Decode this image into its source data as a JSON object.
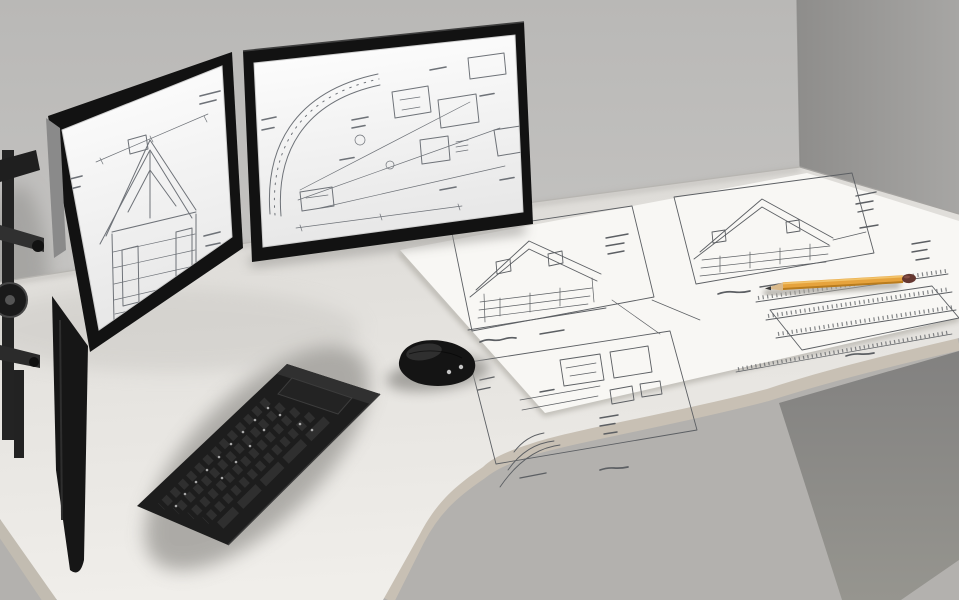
{
  "scene": {
    "type": "photo-illustration",
    "subject": "Corner office desk with a dual-monitor arm showing architectural blueprint drawings, a wireless keyboard, a mouse, a large blueprint sheet and a pencil",
    "objects": [
      {
        "name": "left-monitor",
        "shows": "house cross-section blueprint"
      },
      {
        "name": "right-monitor",
        "shows": "site plan blueprint with curved road"
      },
      {
        "name": "monitor-arm",
        "shows": "black articulated dual mount"
      },
      {
        "name": "blueprint-sheet",
        "shows": "house elevation and plan drawings"
      },
      {
        "name": "pencil",
        "shows": "orange pencil with dark eraser"
      },
      {
        "name": "keyboard",
        "shows": "black compact keyboard"
      },
      {
        "name": "mouse",
        "shows": "black wireless mouse"
      },
      {
        "name": "corner-desk",
        "shows": "light curved corner desktop"
      }
    ]
  },
  "palette": {
    "wall_left_top": "#b9b8b6",
    "wall_left_bottom": "#d2d1cf",
    "wall_right_near": "#8e8d8b",
    "wall_right_far": "#a7a6a4",
    "floor": "#b3b1ae",
    "under_desk_top": "#828180",
    "under_desk_bottom": "#96958f",
    "desk_back": "#dbd9d5",
    "desk_front": "#f0eeea",
    "desk_edge": "#c8c0b4",
    "desk_edge_left": "#c2bcb1",
    "paper": "#f8f7f4",
    "blueprint_line": "#6e7278",
    "paper_line": "#5c5f63",
    "monitor_frame": "#121212",
    "frame_highlight": "#3f3f3f",
    "screen_top": "#ffffff",
    "screen_bottom": "#e7e7e7",
    "keyboard": "#1d1d1d",
    "keyboard_face": "#303030",
    "key_color": "#2f2f2f",
    "mouse": "#141414",
    "shadow": "#9d9b97",
    "arm": "#232323",
    "pencil": "#e6a33d",
    "pencil_dark": "#b97c1e",
    "pencil_light": "#f2c36a",
    "pencil_wood": "#d9b98b",
    "pencil_lead": "#3a3a3a",
    "pencil_eraser": "#653730"
  }
}
